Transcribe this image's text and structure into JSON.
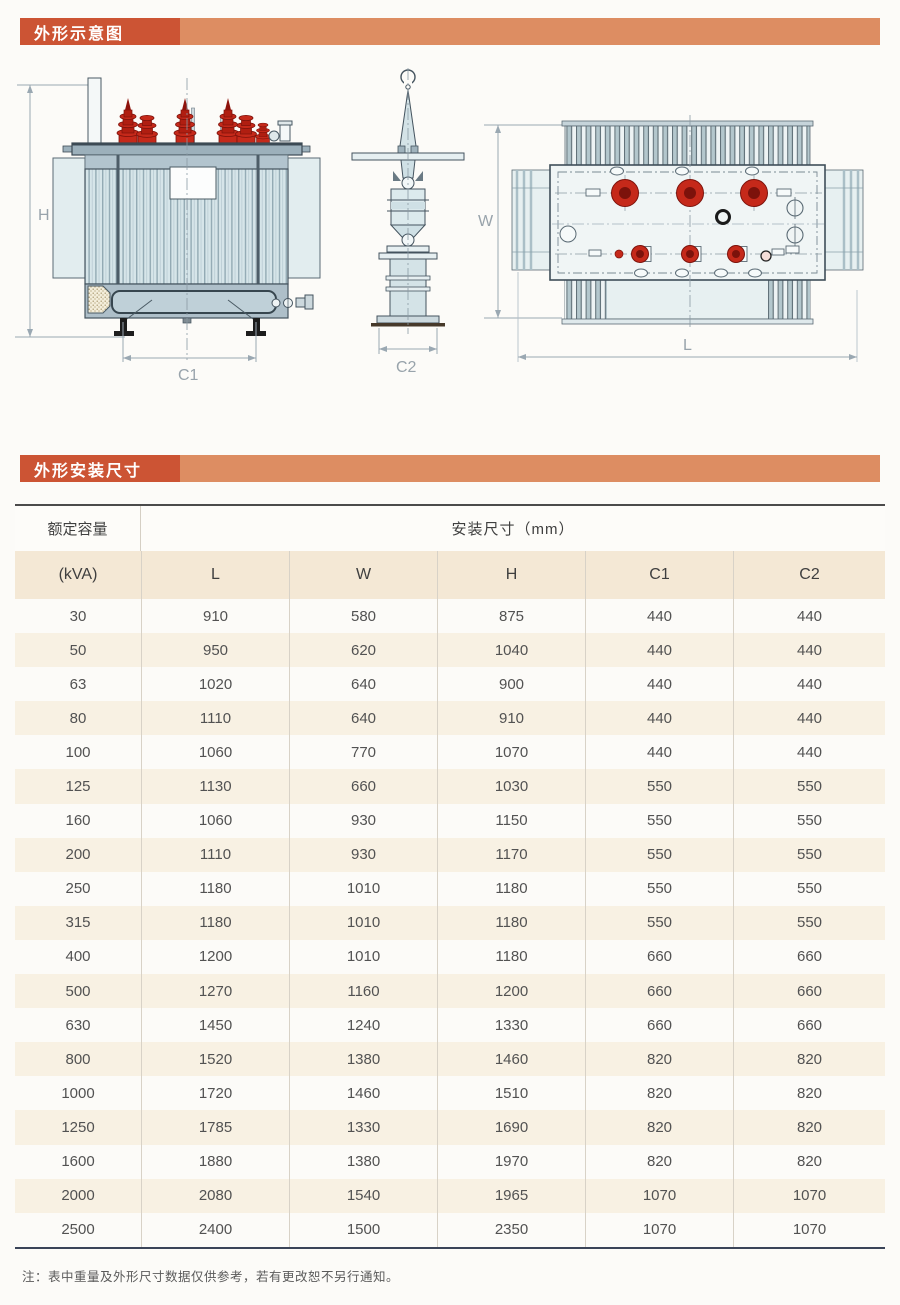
{
  "sections": {
    "schematic_title": "外形示意图",
    "dimensions_title": "外形安装尺寸"
  },
  "diagram": {
    "labels": {
      "h": "H",
      "w": "W",
      "l": "L",
      "c1": "C1",
      "c2": "C2"
    }
  },
  "table": {
    "header": {
      "rated_capacity": "额定容量",
      "unit": "(kVA)",
      "group": "安装尺寸（mm）",
      "columns": [
        "L",
        "W",
        "H",
        "C1",
        "C2"
      ]
    },
    "rows": [
      {
        "kva": "30",
        "l": "910",
        "w": "580",
        "h": "875",
        "c1": "440",
        "c2": "440"
      },
      {
        "kva": "50",
        "l": "950",
        "w": "620",
        "h": "1040",
        "c1": "440",
        "c2": "440"
      },
      {
        "kva": "63",
        "l": "1020",
        "w": "640",
        "h": "900",
        "c1": "440",
        "c2": "440"
      },
      {
        "kva": "80",
        "l": "1110",
        "w": "640",
        "h": "910",
        "c1": "440",
        "c2": "440"
      },
      {
        "kva": "100",
        "l": "1060",
        "w": "770",
        "h": "1070",
        "c1": "440",
        "c2": "440"
      },
      {
        "kva": "125",
        "l": "1130",
        "w": "660",
        "h": "1030",
        "c1": "550",
        "c2": "550"
      },
      {
        "kva": "160",
        "l": "1060",
        "w": "930",
        "h": "1150",
        "c1": "550",
        "c2": "550"
      },
      {
        "kva": "200",
        "l": "1110",
        "w": "930",
        "h": "1170",
        "c1": "550",
        "c2": "550"
      },
      {
        "kva": "250",
        "l": "1180",
        "w": "1010",
        "h": "1180",
        "c1": "550",
        "c2": "550"
      },
      {
        "kva": "315",
        "l": "1180",
        "w": "1010",
        "h": "1180",
        "c1": "550",
        "c2": "550"
      },
      {
        "kva": "400",
        "l": "1200",
        "w": "1010",
        "h": "1180",
        "c1": "660",
        "c2": "660"
      },
      {
        "kva": "500",
        "l": "1270",
        "w": "1160",
        "h": "1200",
        "c1": "660",
        "c2": "660"
      },
      {
        "kva": "630",
        "l": "1450",
        "w": "1240",
        "h": "1330",
        "c1": "660",
        "c2": "660"
      },
      {
        "kva": "800",
        "l": "1520",
        "w": "1380",
        "h": "1460",
        "c1": "820",
        "c2": "820"
      },
      {
        "kva": "1000",
        "l": "1720",
        "w": "1460",
        "h": "1510",
        "c1": "820",
        "c2": "820"
      },
      {
        "kva": "1250",
        "l": "1785",
        "w": "1330",
        "h": "1690",
        "c1": "820",
        "c2": "820"
      },
      {
        "kva": "1600",
        "l": "1880",
        "w": "1380",
        "h": "1970",
        "c1": "820",
        "c2": "820"
      },
      {
        "kva": "2000",
        "l": "2080",
        "w": "1540",
        "h": "1965",
        "c1": "1070",
        "c2": "1070"
      },
      {
        "kva": "2500",
        "l": "2400",
        "w": "1500",
        "h": "2350",
        "c1": "1070",
        "c2": "1070"
      }
    ]
  },
  "note": "注：表中重量及外形尺寸数据仅供参考，若有更改恕不另行通知。",
  "colors": {
    "accent_dark": "#cc5434",
    "accent_light": "#dd8d62",
    "header_beige": "#f4e8d5",
    "stripe_beige": "#f8f1e3",
    "bushing_red": "#c5291a",
    "drawing_line": "#44535e",
    "tank_fill": "#d6e5e9"
  }
}
